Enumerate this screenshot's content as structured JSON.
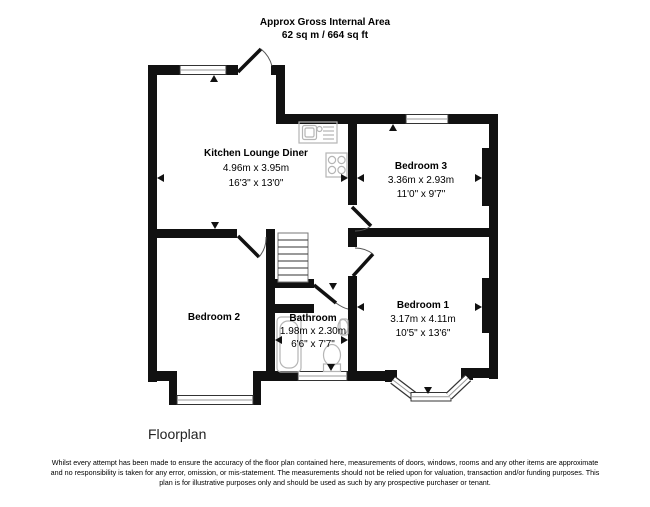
{
  "header": {
    "line1": "Approx Gross Internal Area",
    "line2": "62 sq m / 664 sq ft"
  },
  "rooms": [
    {
      "name": "Kitchen Lounge Diner",
      "metric": "4.96m x 3.95m",
      "imperial": "16'3\" x 13'0\""
    },
    {
      "name": "Bedroom 3",
      "metric": "3.36m x 2.93m",
      "imperial": "11'0\" x 9'7\""
    },
    {
      "name": "Bedroom 2",
      "metric": "",
      "imperial": ""
    },
    {
      "name": "Bedroom 1",
      "metric": "3.17m x 4.11m",
      "imperial": "10'5\" x 13'6\""
    },
    {
      "name": "Bathroom",
      "metric": "1.98m x 2.30m",
      "imperial": "6'6\" x 7'7\""
    }
  ],
  "caption": "Floorplan",
  "disclaimer": "Whilst every attempt has been made to ensure the accuracy of the floor plan contained here, measurements of doors, windows, rooms and any other items are approximate and no responsibility is taken for any error, omission, or mis-statement. The measurements should not be relied upon for valuation, transaction and/or funding purposes. This plan is for illustrative purposes only and should be used as such by any prospective purchaser or tenant.",
  "colors": {
    "wall": "#111111",
    "fixture_outline": "#b5b5b5",
    "window_mid": "#999999",
    "text": "#000000"
  }
}
